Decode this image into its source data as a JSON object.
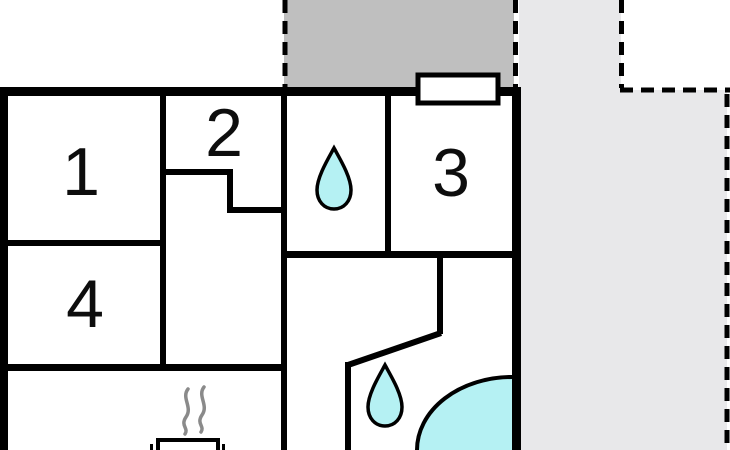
{
  "floorplan": {
    "type": "house-floor-plan",
    "rooms": [
      {
        "number": "1"
      },
      {
        "number": "2"
      },
      {
        "number": "3"
      },
      {
        "number": "4"
      }
    ],
    "icons": {
      "bathroom_small": "water-drop-icon",
      "bathroom_large": "water-drop-icon",
      "shower": "corner-shower-icon",
      "stove": "wood-stove-icon",
      "steam": "steam-squiggles-icon",
      "window": "window-icon"
    },
    "areas": {
      "deck": "covered-terrace",
      "patio": "open-terrace"
    },
    "colors": {
      "wall": "#000000",
      "water_fill": "#b5f1f3",
      "deck_fill": "#bfbfbf",
      "patio_fill": "#e8e8ea",
      "steam": "#8a8a8a",
      "background": "#ffffff",
      "window_fill": "#ffffff"
    }
  }
}
